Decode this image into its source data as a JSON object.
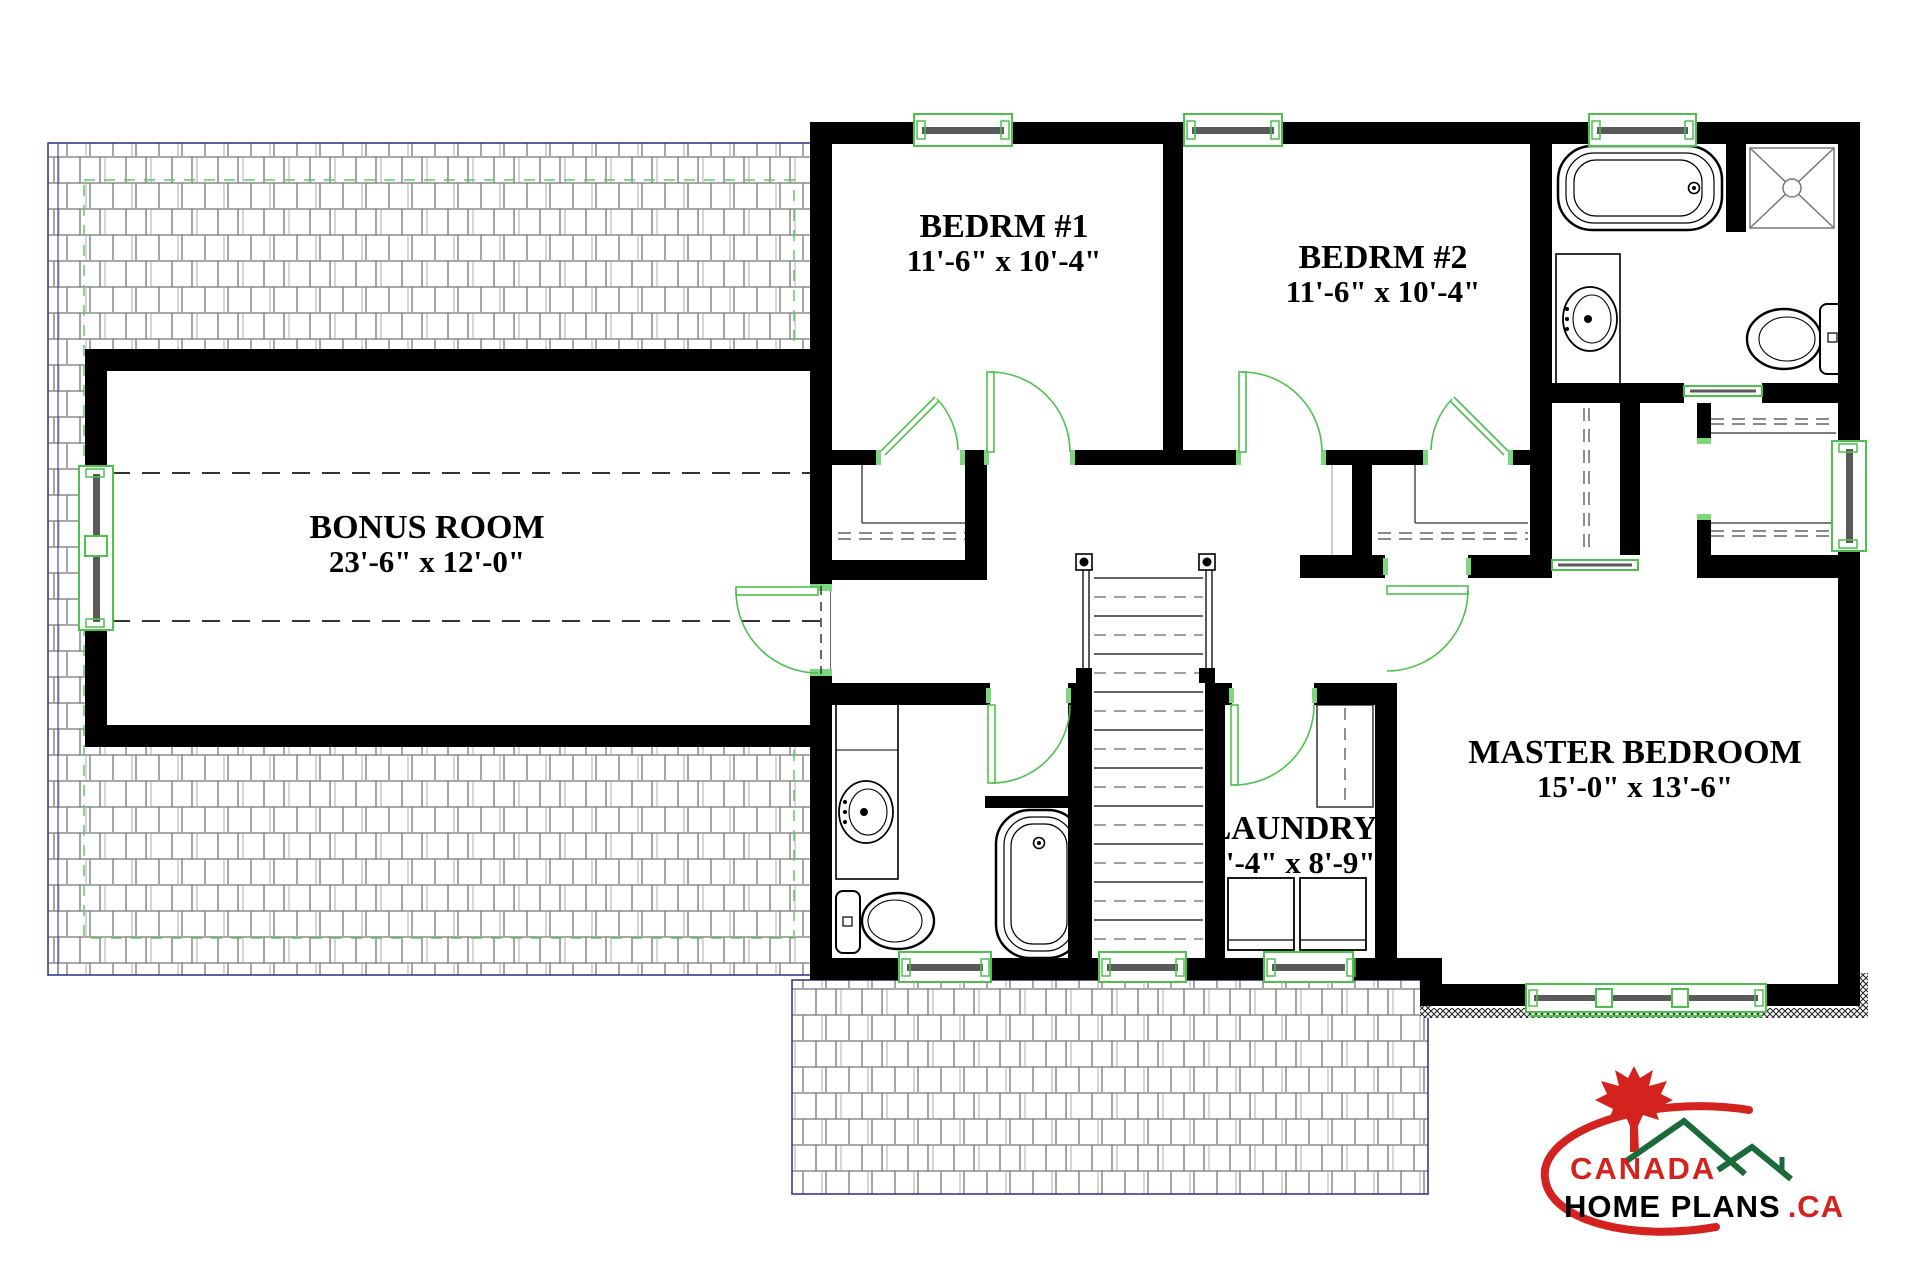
{
  "rooms": [
    {
      "name": "BONUS ROOM",
      "dims": "23'-6\" x 12'-0\""
    },
    {
      "name": "BEDRM #1",
      "dims": "11'-6\" x 10'-4\""
    },
    {
      "name": "BEDRM #2",
      "dims": "11'-6\" x 10'-4\""
    },
    {
      "name": "MASTER BEDROOM",
      "dims": "15'-0\" x 13'-6\""
    },
    {
      "name": "LAUNDRY",
      "dims": "5'-4\" x 8'-9\""
    }
  ],
  "logo": {
    "line1": "CANADA",
    "line2": "HOME PLANS",
    "suffix": ".CA"
  },
  "palette": {
    "wall_black": "#000000",
    "symbol_green": "#4cc24c",
    "hatch_line": "#767676",
    "hatch_border": "#2b2b86",
    "sash_gray": "#5a5a5a",
    "logo_red": "#d4231f",
    "logo_green": "#1b6b39",
    "text_black": "#000000"
  },
  "fixtures": [
    "bathtub",
    "shower",
    "toilet",
    "sink-vanity",
    "washer",
    "dryer",
    "stairs",
    "closet-shelf",
    "window",
    "door",
    "railing"
  ]
}
